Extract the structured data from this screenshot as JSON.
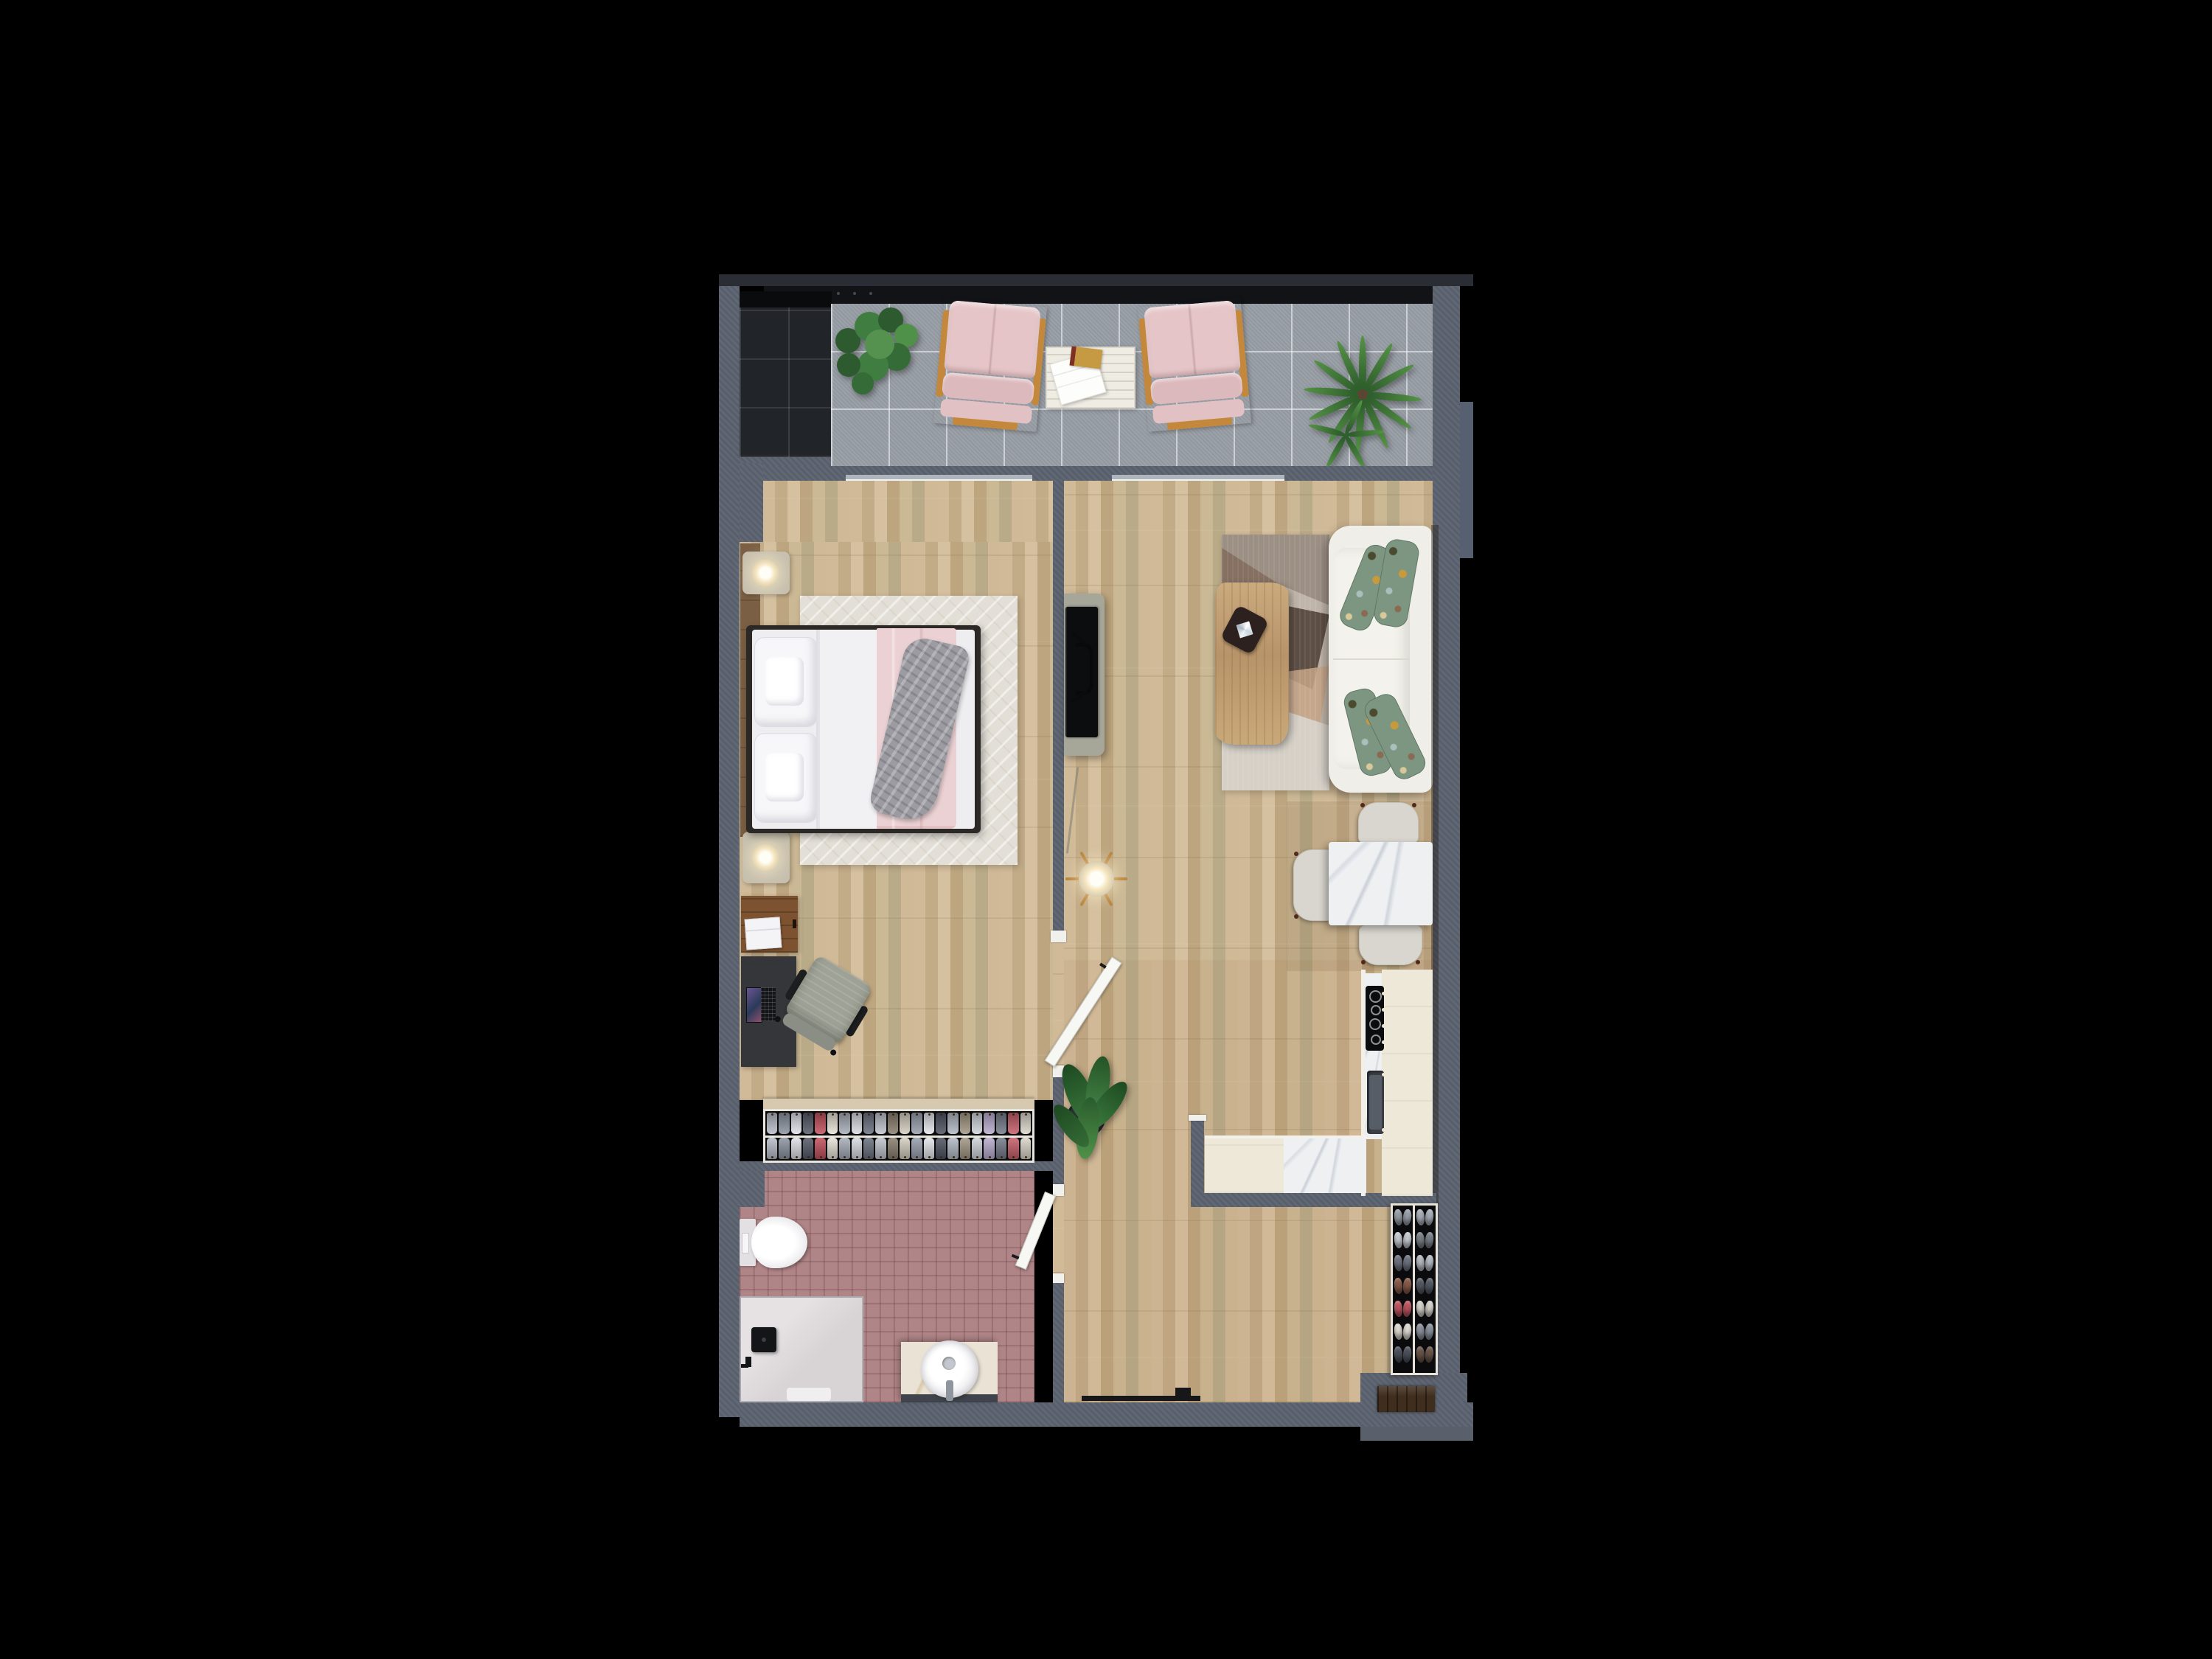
{
  "scene": {
    "title": "apartment-floor-plan-top-view-render",
    "background": "#000000",
    "description": "Top-down 3D render of a one-bedroom apartment floor plan on black background"
  },
  "palette": {
    "wall": "#5c6370",
    "railing": "#121317",
    "balcony_tile": "#989ea5",
    "balcony_dark_tile": "#212428",
    "wood_floor": "#c8b190",
    "bath_tile": "#b08587",
    "marble": "#eef0f2",
    "kitchen_cabinet": "#eee8d8",
    "sofa": "#efeee8",
    "pillow_green": "#7d9681",
    "blanket_pink": "#ebd1d3",
    "tv_console": "#a6a699",
    "chair_pink": "#e5c5c8",
    "wood_furniture": "#c4883c",
    "door_front": "#3f2d1d"
  },
  "rooms": {
    "balcony": {
      "label": "Balcony",
      "items": [
        "fiddle leaf plant",
        "pink lounge chair",
        "slatted side table with magazines",
        "pink lounge chair",
        "palm plant"
      ]
    },
    "bedroom": {
      "label": "Bedroom",
      "items": [
        "nightstand with lamp",
        "double bed with pink blanket and gray throw",
        "area rug",
        "nightstand with lamp",
        "wood dresser with books",
        "desk with laptop",
        "office chair",
        "open wardrobe with clothes"
      ]
    },
    "living_room": {
      "label": "Living room",
      "items": [
        "tv sideboard",
        "flat tv",
        "patchwork rug",
        "live-edge coffee table with tray",
        "white sofa with green pillows",
        "pendant lamp",
        "marble dining table",
        "3 dining chairs"
      ]
    },
    "kitchen": {
      "label": "Kitchen",
      "items": [
        "cream cabinet run",
        "cooktop",
        "sink",
        "marble counter"
      ]
    },
    "bathroom": {
      "label": "Bathroom",
      "items": [
        "wall-hung toilet",
        "walk-in shower",
        "black shower head",
        "marble vanity with round sink",
        "bath mat"
      ]
    },
    "hallway": {
      "label": "Hallway",
      "items": [
        "potted banana plant",
        "pendant lamp",
        "shoe rack",
        "entrance door",
        "threshold vent"
      ]
    }
  },
  "counts": {
    "sofa_pillows": 4,
    "dining_chairs": 3,
    "balcony_lounge_chairs": 2,
    "nightstands": 2,
    "doors_open": 2
  },
  "wardrobe": {
    "items": [
      "#b9bec8",
      "#8e95a2",
      "#dfe2e8",
      "#555b68",
      "#c2525e",
      "#e8e3d8",
      "#a8aeb9",
      "#d9dce2",
      "#6b7280",
      "#c0c4cd",
      "#8a7f6e",
      "#d6cfc0",
      "#9aa1ae",
      "#e4e6ea",
      "#4e5462",
      "#b4bac4",
      "#a39884",
      "#d0d4da",
      "#b9add0",
      "#757c8a",
      "#c75f6a",
      "#dcd6ca"
    ]
  },
  "shoe_rack": {
    "left": [
      "#9aa0aa",
      "#c8ccd2",
      "#6e7480",
      "#8a5a48",
      "#c05560",
      "#e2ded6",
      "#4c515c"
    ],
    "right": [
      "#aab0ba",
      "#7a8088",
      "#b8bcc4",
      "#555a64",
      "#d8d4cc",
      "#8d939e",
      "#6a5448"
    ]
  }
}
